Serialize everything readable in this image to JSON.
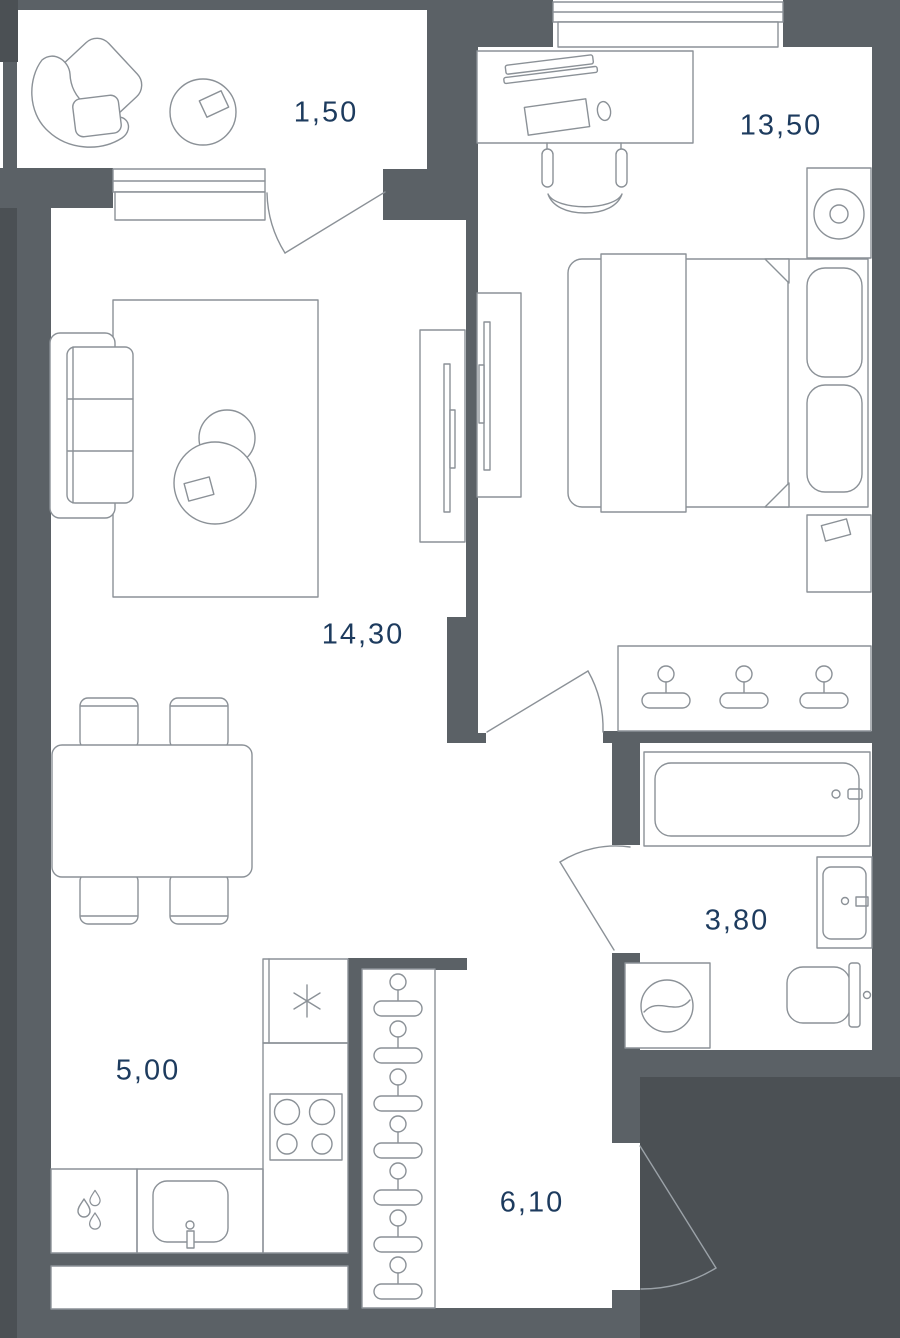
{
  "plan": {
    "type": "apartment-floor-plan",
    "rooms": [
      {
        "id": "balcony",
        "area": "1,50"
      },
      {
        "id": "bedroom",
        "area": "13,50"
      },
      {
        "id": "living-room",
        "area": "14,30"
      },
      {
        "id": "bathroom",
        "area": "3,80"
      },
      {
        "id": "kitchen",
        "area": "5,00"
      },
      {
        "id": "hallway",
        "area": "6,10"
      }
    ],
    "colors": {
      "wall": "#5b6166",
      "outside": "#4b5054",
      "line": "#8b9197",
      "label": "#1d3b5e",
      "floor": "#ffffff"
    }
  }
}
